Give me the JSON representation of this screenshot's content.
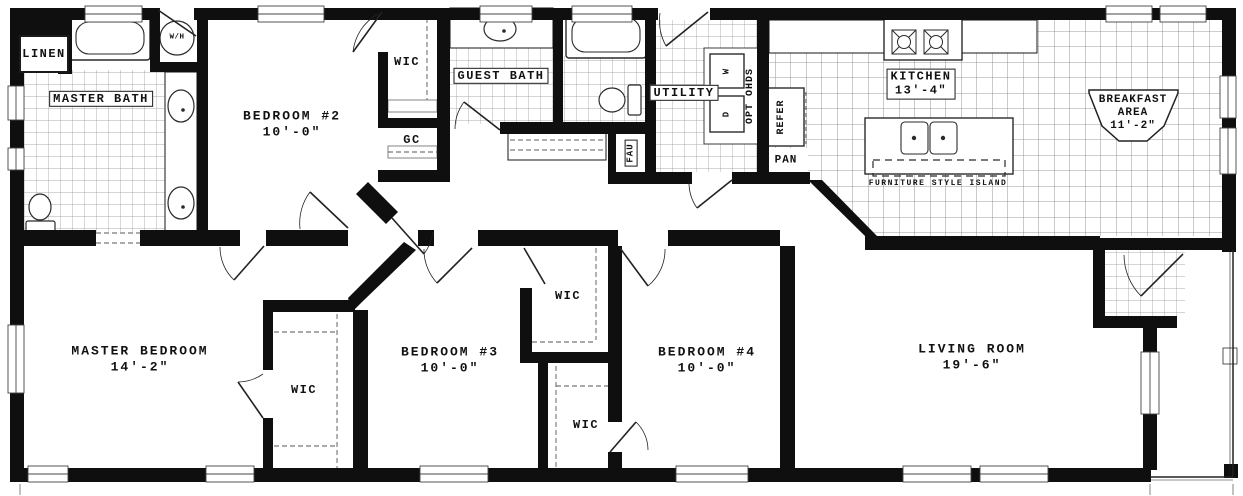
{
  "plan_title": "Floor Plan",
  "rooms": {
    "linen": {
      "label": "LINEN"
    },
    "master_bath": {
      "label": "MASTER BATH"
    },
    "water_heater": {
      "label": "W/H"
    },
    "bedroom2": {
      "label": "BEDROOM #2",
      "dim": "10'-0\""
    },
    "wic_bedroom2": {
      "label": "WIC"
    },
    "gc": {
      "label": "GC"
    },
    "guest_bath": {
      "label": "GUEST BATH"
    },
    "utility": {
      "label": "UTILITY"
    },
    "fau": {
      "label": "FAU"
    },
    "washer": {
      "label": "W"
    },
    "dryer": {
      "label": "D"
    },
    "opt_ohds": {
      "label": "OPT OHDS"
    },
    "refrigerator": {
      "label": "REFER"
    },
    "pantry": {
      "label": "PAN"
    },
    "kitchen": {
      "label": "KITCHEN",
      "dim": "13'-4\""
    },
    "island": {
      "label": "FURNITURE STYLE ISLAND"
    },
    "breakfast": {
      "label": "BREAKFAST",
      "label2": "AREA",
      "dim": "11'-2\""
    },
    "master_bedroom": {
      "label": "MASTER BEDROOM",
      "dim": "14'-2\""
    },
    "wic_master": {
      "label": "WIC"
    },
    "bedroom3": {
      "label": "BEDROOM #3",
      "dim": "10'-0\""
    },
    "wic_bedroom3": {
      "label": "WIC"
    },
    "wic_bedroom4": {
      "label": "WIC"
    },
    "bedroom4": {
      "label": "BEDROOM #4",
      "dim": "10'-0\""
    },
    "living_room": {
      "label": "LIVING ROOM",
      "dim": "19'-6\""
    }
  },
  "colors": {
    "wall": "#0f0f0f",
    "tile_line": "#888888",
    "background": "#ffffff"
  }
}
